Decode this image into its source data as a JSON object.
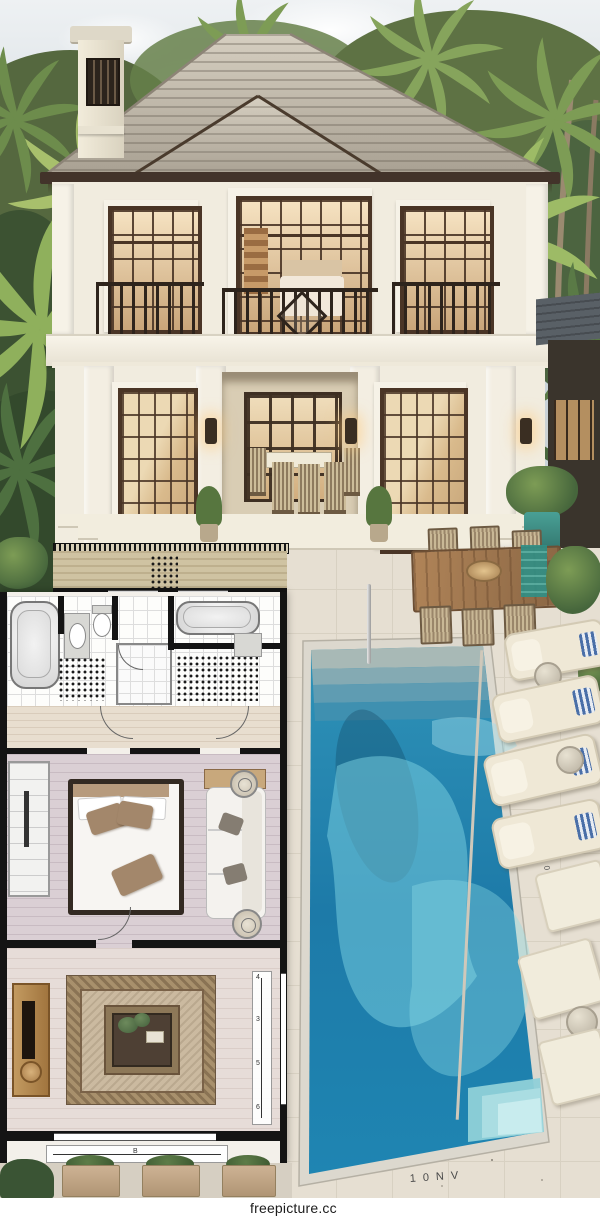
{
  "watermark": {
    "text": "freepicture.cc"
  },
  "pool": {
    "bottom_mark": "10NV",
    "side_mark": "0110"
  },
  "floorplan": {
    "dim_bottom_label": "B",
    "dim_right_labels": [
      "4",
      "3",
      "5",
      "6"
    ]
  },
  "colors": {
    "sky1": "#eef1f3",
    "sky2": "#c9d3d9",
    "wall": "#f1ecdf",
    "frame": "#4a3526",
    "fascia": "#42332a",
    "deck": "#e6dfd2",
    "lounge": "#efe8d6",
    "pillowblue": "#4a6fa8",
    "planwall": "#141414",
    "planbg": "#f3f0ea",
    "bedfloor": "#dacfd4",
    "livfloor": "#e6dcd8",
    "rug1": "#a8906c",
    "rug2": "#cbbaa0",
    "wm_bg": "#ffffff",
    "wm_fg": "#1c1c1c"
  }
}
